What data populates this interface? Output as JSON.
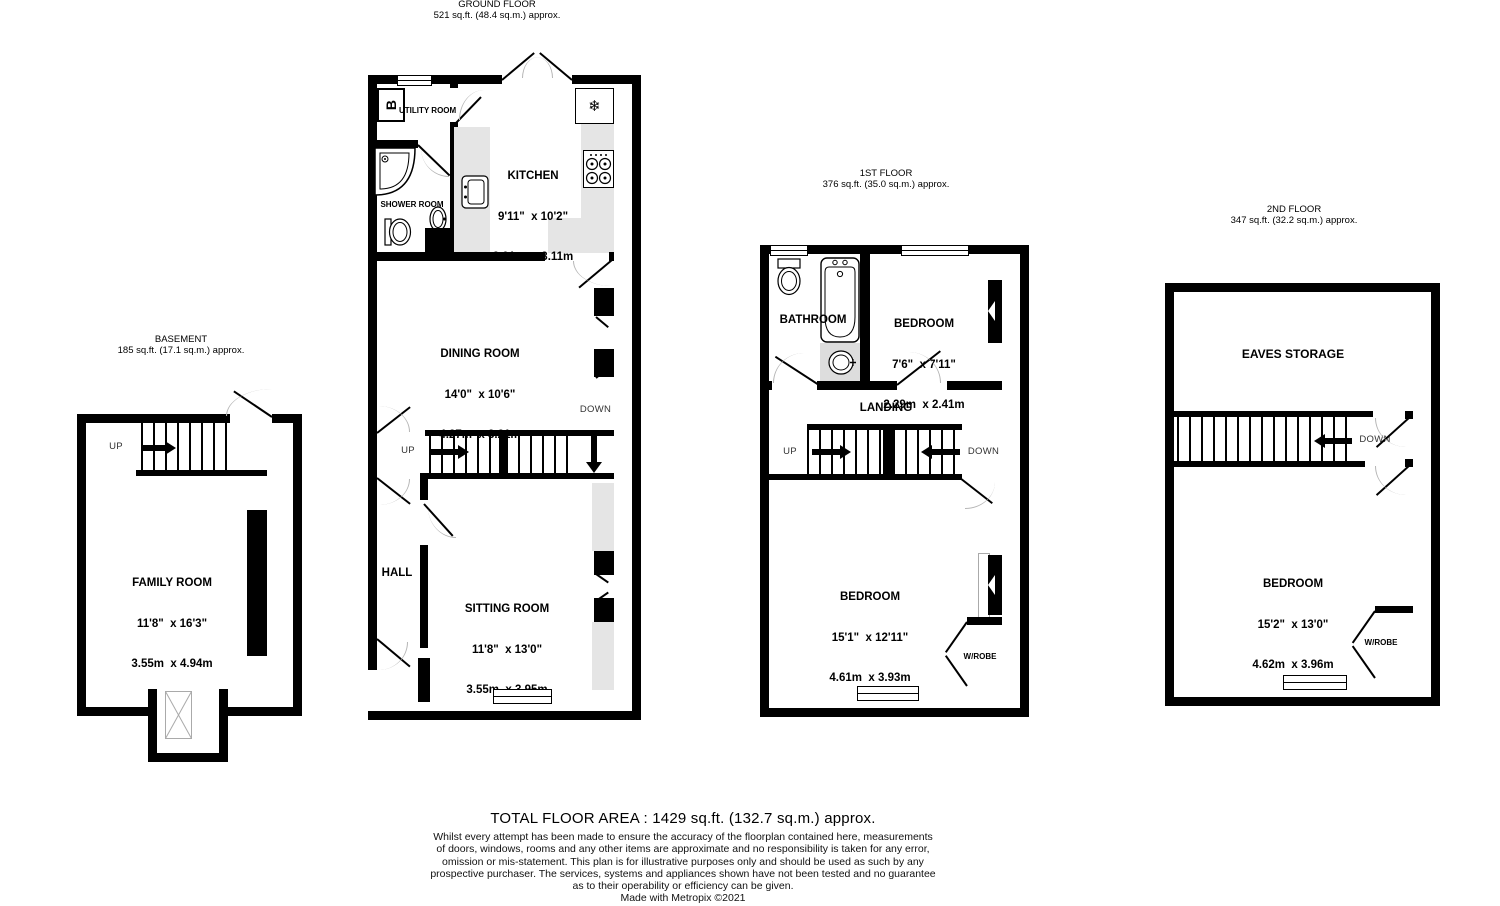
{
  "floors": {
    "basement": {
      "title": "BASEMENT",
      "area": "185 sq.ft. (17.1 sq.m.) approx.",
      "stairs": {
        "up": "UP"
      },
      "rooms": {
        "family_room": {
          "name": "FAMILY ROOM",
          "imperial": "11'8\"  x 16'3\"",
          "metric": "3.55m  x 4.94m"
        }
      }
    },
    "ground": {
      "title": "GROUND FLOOR",
      "area": "521 sq.ft. (48.4 sq.m.) approx.",
      "stairs": {
        "up": "UP",
        "down": "DOWN"
      },
      "boiler": "B",
      "freezer_icon": "❄",
      "rooms": {
        "utility": {
          "name": "UTILITY ROOM"
        },
        "shower": {
          "name": "SHOWER ROOM"
        },
        "kitchen": {
          "name": "KITCHEN",
          "imperial": "9'11\"  x 10'2\"",
          "metric": "3.01m  x 3.11m"
        },
        "dining": {
          "name": "DINING ROOM",
          "imperial": "14'0\"  x 10'6\"",
          "metric": "4.27m  x 3.21m"
        },
        "hall": {
          "name": "HALL"
        },
        "sitting": {
          "name": "SITTING ROOM",
          "imperial": "11'8\"  x 13'0\"",
          "metric": "3.55m  x 3.95m"
        }
      }
    },
    "first": {
      "title": "1ST FLOOR",
      "area": "376 sq.ft. (35.0 sq.m.) approx.",
      "stairs": {
        "up": "UP",
        "down": "DOWN"
      },
      "rooms": {
        "bathroom": {
          "name": "BATHROOM"
        },
        "bedroom_small": {
          "name": "BEDROOM",
          "imperial": "7'6\"  x 7'11\"",
          "metric": "2.29m  x 2.41m"
        },
        "landing": {
          "name": "LANDING"
        },
        "bedroom_large": {
          "name": "BEDROOM",
          "imperial": "15'1\"  x 12'11\"",
          "metric": "4.61m  x 3.93m"
        },
        "wardrobe": {
          "name": "W/ROBE"
        }
      }
    },
    "second": {
      "title": "2ND FLOOR",
      "area": "347 sq.ft. (32.2 sq.m.) approx.",
      "stairs": {
        "down": "DOWN"
      },
      "rooms": {
        "eaves": {
          "name": "EAVES STORAGE"
        },
        "bedroom": {
          "name": "BEDROOM",
          "imperial": "15'2\"  x 13'0\"",
          "metric": "4.62m  x 3.96m"
        },
        "wardrobe": {
          "name": "W/ROBE"
        }
      }
    }
  },
  "footer": {
    "total": "TOTAL FLOOR AREA : 1429 sq.ft. (132.7 sq.m.) approx.",
    "disclaimer": [
      "Whilst every attempt has been made to ensure the accuracy of the floorplan contained here, measurements",
      "of doors, windows, rooms and any other items are approximate and no responsibility is taken for any error,",
      "omission or mis-statement. This plan is for illustrative purposes only and should be used as such by any",
      "prospective purchaser. The services, systems and appliances shown have not been tested and no guarantee",
      "as to their operability or efficiency can be given."
    ],
    "credit": "Made with Metropix ©2021"
  }
}
